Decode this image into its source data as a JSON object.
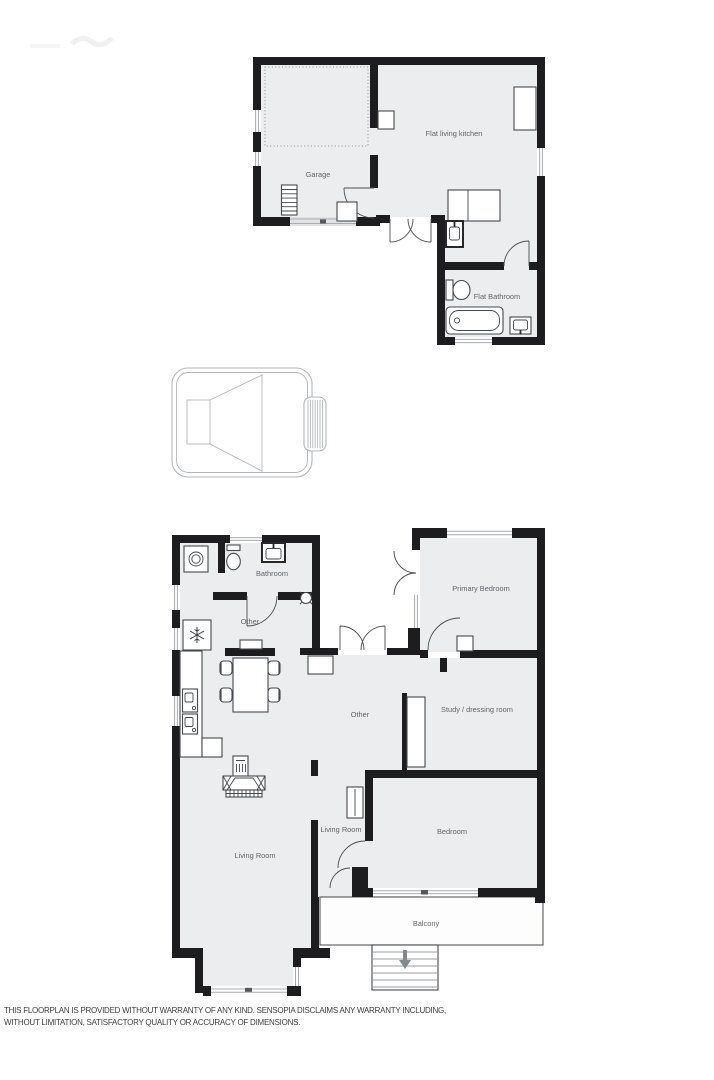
{
  "colors": {
    "wall": "#1d1d1f",
    "floor": "#ebedef",
    "label": "#606468",
    "fixture": "#45494d",
    "window": "#a8acb0",
    "disclaimer": "#404040"
  },
  "plans": {
    "flat": {
      "rooms": [
        {
          "name": "Garage"
        },
        {
          "name": "Flat living kitchen"
        },
        {
          "name": "Flat Bathroom"
        }
      ]
    },
    "main": {
      "rooms": [
        {
          "name": "Bathroom"
        },
        {
          "name": "Other"
        },
        {
          "name": "Primary Bedroom"
        },
        {
          "name": "Study / dressing room"
        },
        {
          "name": "Other"
        },
        {
          "name": "Living Room"
        },
        {
          "name": "Living Room"
        },
        {
          "name": "Bedroom"
        },
        {
          "name": "Balcony"
        }
      ]
    }
  },
  "icons": {
    "washing_machine": "square-with-drum-circle",
    "toilet": "cistern-and-bowl",
    "wall_sink": "basin-in-dark-frame",
    "ceiling_light": "circle-with-ticks",
    "fridge": "snowflake-in-square",
    "dining_table": "table-with-four-chairs",
    "radiator": "grill-square",
    "fireplace": "hearth-with-brick-strip",
    "bathtub": "rounded-tub-with-drain",
    "stairs": "tread-rectangle",
    "stairs_arrow": "down-arrow",
    "hot_tub": "rounded-tub-with-ladder",
    "garage_door": "window-strip",
    "wardrobe": "white-rectangle"
  },
  "disclaimer": {
    "line1": "THIS FLOORPLAN IS PROVIDED WITHOUT WARRANTY OF ANY KIND. SENSOPIA DISCLAIMS ANY WARRANTY INCLUDING,",
    "line2": "WITHOUT LIMITATION, SATISFACTORY QUALITY OR ACCURACY OF DIMENSIONS."
  }
}
